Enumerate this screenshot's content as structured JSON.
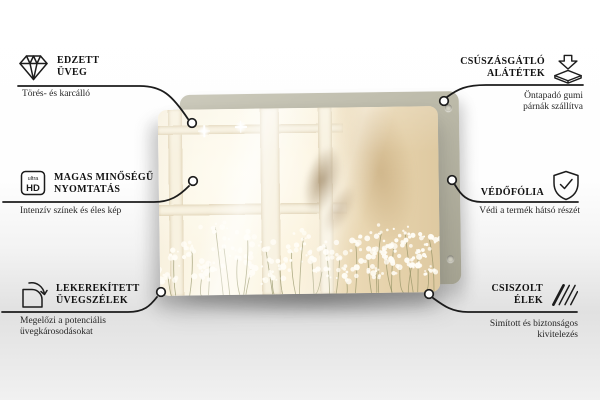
{
  "callouts": [
    {
      "id": "tempered-glass",
      "icon": "diamond-icon",
      "title1": "EDZETT",
      "title2": "ÜVEG",
      "sub1": "Törés- és karcálló"
    },
    {
      "id": "anti-slip-pads",
      "icon": "pad-arrow-icon",
      "title1": "CSÚSZÁSGÁTLÓ",
      "title2": "ALÁTÉTEK",
      "sub1": "Öntapadó gumi",
      "sub2": "párnák szállítva"
    },
    {
      "id": "high-quality-print",
      "icon": "ultra-hd-icon",
      "title1": "MAGAS MINŐSÉGŰ",
      "title2": "NYOMTATÁS",
      "sub1": "Intenzív színek és éles kép"
    },
    {
      "id": "protective-film",
      "icon": "shield-check-icon",
      "title1": "VÉDŐFÓLIA",
      "sub1": "Védi a termék hátsó részét"
    },
    {
      "id": "rounded-glass-edges",
      "icon": "rounded-corner-icon",
      "title1": "LEKEREKÍTETT",
      "title2": "ÜVEGSZÉLEK",
      "sub1": "Megelőzi a potenciális",
      "sub2": "üvegkárosodásokat"
    },
    {
      "id": "polished-edges",
      "icon": "hatched-edge-icon",
      "title1": "CSISZOLT",
      "title2": "ÉLEK",
      "sub1": "Simított és biztonságos",
      "sub2": "kivitelezés"
    }
  ],
  "ultra_hd_icon": {
    "small": "ultra",
    "big": "HD"
  },
  "colors": {
    "line": "#1c1c1c",
    "title_text": "#121212",
    "subtitle_text": "#262626",
    "backing_panel": "#b7b5a3",
    "glass_scene_warm": "#f4e9cf",
    "flowers": "#fffdf6",
    "background_bottom": "#e1e1e1"
  }
}
